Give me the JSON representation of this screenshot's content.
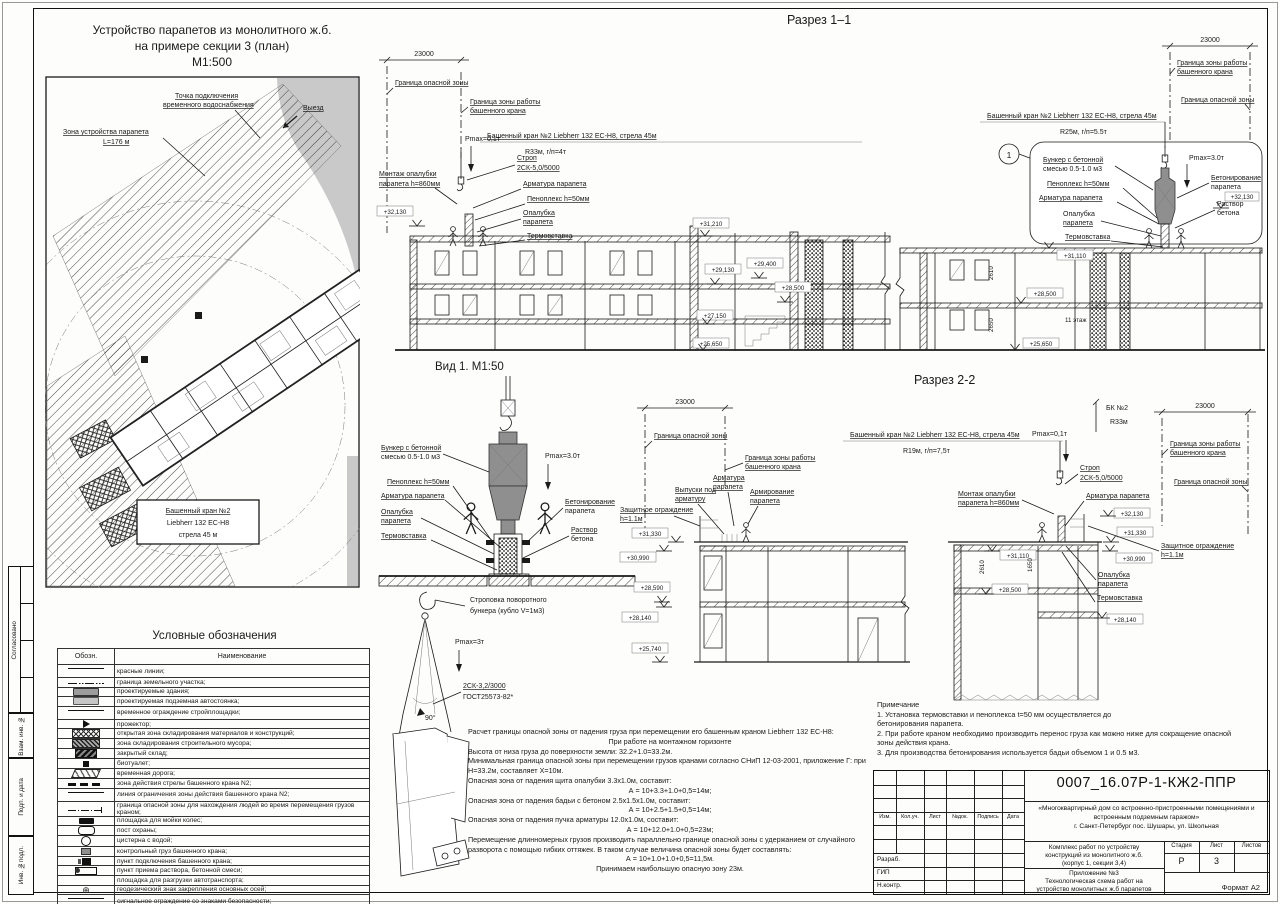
{
  "page": {
    "format": "Формат А2"
  },
  "sidebar": {
    "approved": "Согласовано",
    "vzam": "Взам. инв. №",
    "podp": "Подп. и дата",
    "inv": "Инв. №подл."
  },
  "common": {
    "danger": "Граница опасной зоны",
    "work1": "Граница зоны работы",
    "work2": "башенного крана",
    "crane": "Башенный кран №2 Liebherr 132 EC-H8, стрела 45м",
    "dim": "23000",
    "sling1": "Строп",
    "sling2": "2СК-5,0/5000",
    "rebar": "Арматура парапета",
    "penoplex": "Пеноплекс h=50мм",
    "form1": "Опалубка",
    "form2": "парапета",
    "thermo": "Термовставка",
    "mount1": "Монтаж опалубки",
    "mount2": "парапета h=860мм",
    "bunker1": "Бункер с бетонной",
    "bunker2": "смесью 0.5-1.0 м3",
    "conc1": "Бетонирование",
    "conc2": "парапета",
    "mortar1": "Раствор",
    "mortar2": "бетона",
    "guard1": "Защитное ограждение",
    "guard2": "h=1.1м",
    "pmax01": "Pmax=0,1т",
    "pmax3": "Pmax=3.0т"
  },
  "elev": {
    "e32130": "+32,130",
    "e31210": "+31,210",
    "e29130": "+29,130",
    "e29400": "+29,400",
    "e28500": "+28,500",
    "e27150": "+27,150",
    "e25650": "+25,650",
    "e31110": "+31,110",
    "e31330": "+31,330",
    "e30990": "+30,990",
    "e28590": "+28,590",
    "e28140": "+28,140",
    "e25740": "+25,740"
  },
  "plan": {
    "t1": "Устройство парапетов из монолитного ж.б.",
    "t2": "на примере секции 3 (план)",
    "t3": "М1:500",
    "water1": "Точка подключения",
    "water2": "временного водоснабжения",
    "zone1": "Зона устройства парапета",
    "zone2": "L=176 м",
    "crane1": "Башенный кран №2",
    "crane2": "Liebherr 132 EC-H8",
    "crane3": "стрела 45 м",
    "exit": "Выезд"
  },
  "s1": {
    "title": "Разрез 1–1",
    "r33": "R33м, г/п=4т",
    "r25": "R25м, г/п=5.5т",
    "floor": "11 этаж",
    "callout": "1",
    "d2610": "2610",
    "d2650": "2650"
  },
  "view1": {
    "title": "Вид 1. М1:50"
  },
  "s2": {
    "title": "Разрез 2-2",
    "r19": "R19м, г/п=7,5т",
    "bk": "БК №2",
    "r33": "R33м",
    "reb1": "Арматура",
    "reb2": "парапета",
    "vyp1": "Выпуски под",
    "vyp2": "арматуру",
    "arm1": "Армирование",
    "arm2": "парапета",
    "d2610": "2610",
    "d1650": "1650"
  },
  "sling": {
    "t1": "Строповка поворотного",
    "t2": "бункера (кубло V=1м3)",
    "pmax": "Pmax=3т",
    "s1": "2СК-3,2/3000",
    "s2": "ГОСТ25573-82*",
    "angle": "90°"
  },
  "calc": {
    "lines": [
      "Расчет границы опасной зоны от падения груза при перемещении его башенным краном Liebherr 132 EC-H8:",
      "При работе на монтажном горизонте",
      "Высота от низа груза до поверхности земли: 32.2+1.0=33.2м.",
      "Минимальная граница опасной зоны при перемещении грузов кранами согласно СНиП 12-03-2001, приложение Г: при",
      "Н=33.2м, составляет Х=10м.",
      "Опасная зона от падения щита опалубки 3.3х1.0м, составит:",
      "А = 10+3.3+1.0+0,5=14м;",
      "Опасная зона от падения бадьи с бетоном 2.5х1.5х1.0м, составит:",
      "А = 10+2.5+1.5+0,5=14м;",
      "Опасная зона от падения пучка арматуры 12.0х1.0м, составит:",
      "А = 10+12.0+1.0+0,5=23м;",
      "Перемещение длинномерных грузов производить параллельно границе опасной зоны с удержанием от случайного",
      "разворота с помощью гибких оттяжек. В таком случае величина опасной зоны будет составлять:",
      "А = 10+1.0+1.0+0,5=11,5м.",
      "Принимаем наибольшую опасную зону 23м."
    ]
  },
  "legend": {
    "title": "Условные обозначения",
    "col1": "Обозн.",
    "col2": "Наименование",
    "rows": [
      "красные линии;",
      "граница земельного участка;",
      "проектируемые здания;",
      "проектируемая подземная автостоянка;",
      "временное ограждение стройплощадки;",
      "прожектор;",
      "открытая зона складирования материалов и конструкций;",
      "зона складирования строительного мусора;",
      "закрытый склад;",
      "биотуалет;",
      "временная дорога;",
      "зона действия стрелы башенного крана N2;",
      "линия ограничения зоны действия башенного крана N2;",
      "граница опасной зоны для нахождения людей во время перемещения грузов краном;",
      "площадка для мойки колес;",
      "пост охраны;",
      "цистерна с водой;",
      "контрольный груз башенного крана;",
      "пункт подключения башенного крана;",
      "пункт приема раствора, бетонной смеси;",
      "площадка для разгрузки автотранспорта;",
      "геодезический знак закрепления основных осей;",
      "сигнальное ограждение со знаками безопасности;"
    ]
  },
  "notes": {
    "title": "Примечание",
    "l1": "1. Установка термовставки и пеноплекса t=50 мм осуществляется до",
    "l2": "бетонирования парапета.",
    "l3": "2. При работе краном необходимо производить перенос груза как можно ниже для сокращение опасной",
    "l4": "зоны действия крана.",
    "l5": "3. Для производства бетонирования используется бадьи объемом 1 и 0.5 м3."
  },
  "tb": {
    "doc": "0007_16.07Р-1-КЖ2-ППР",
    "p1": "«Многоквартирный дом со встроенно-пристроенными помещениями и",
    "p2": "встроенным подземным гаражом»",
    "p3": "г. Санкт-Петербург пос. Шушары, ул. Школьная",
    "w1": "Комплекс работ по устройству",
    "w2": "конструкций из монолитного ж.б.",
    "w3": "(корпус 1, секции 3,4)",
    "stage_l": "Стадия",
    "sheet_l": "Лист",
    "sheets_l": "Листов",
    "stage": "Р",
    "sheet": "3",
    "a1": "Приложение №3",
    "a2": "Технологическая схема работ на",
    "a3": "устройство монолитных ж.б парапетов",
    "h1": "Изм.",
    "h2": "Кол.уч.",
    "h3": "Лист",
    "h4": "№док.",
    "h5": "Подпись",
    "h6": "Дата",
    "r1": "Разраб.",
    "r2": "ГИП",
    "r3": "Н.контр."
  }
}
